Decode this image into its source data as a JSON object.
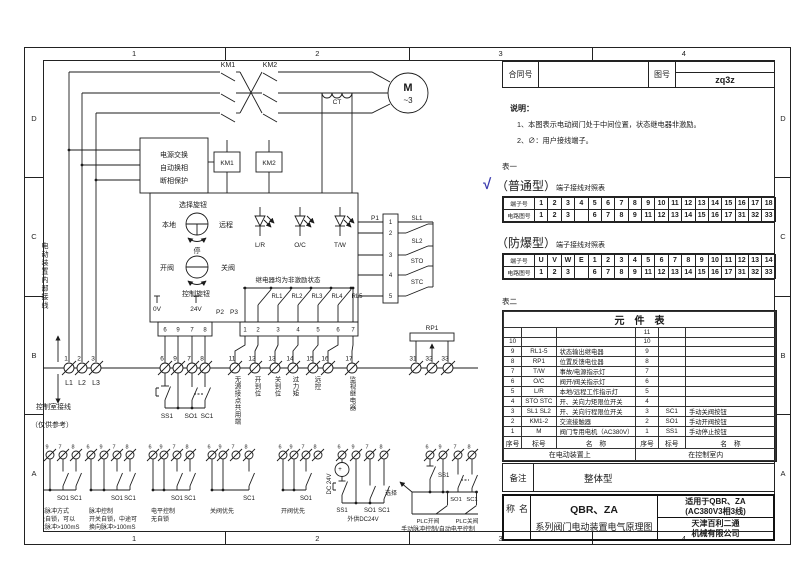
{
  "frame": {
    "top_zones": [
      "1",
      "2",
      "3",
      "4"
    ],
    "bottom_zones": [
      "1",
      "2",
      "3",
      "4"
    ],
    "left_zones": [
      "D",
      "C",
      "B",
      "A"
    ],
    "right_zones": [
      "D",
      "C",
      "B",
      "A"
    ]
  },
  "header": {
    "contract_label": "合同号",
    "drawing_label": "图号",
    "drawing_no": "zq3z"
  },
  "notes": {
    "title": "说明：",
    "items": [
      "1、本图表示电动阀门处于中间位置，状态继电器非激励。",
      "2、∅：用户接线端子。"
    ]
  },
  "table1": {
    "label": "表一",
    "check": "√",
    "normal": {
      "title": "（普通型）",
      "subtitle": "端子接线对照表",
      "row1_label": "端子号",
      "row2_label": "电路图号",
      "terminals": [
        "1",
        "2",
        "3",
        "4",
        "5",
        "6",
        "7",
        "8",
        "9",
        "10",
        "11",
        "12",
        "13",
        "14",
        "15",
        "16",
        "17",
        "18"
      ],
      "circuits": [
        "1",
        "2",
        "3",
        "",
        "6",
        "7",
        "8",
        "9",
        "11",
        "12",
        "13",
        "14",
        "15",
        "16",
        "17",
        "31",
        "32",
        "33"
      ]
    },
    "explosion": {
      "title": "（防爆型）",
      "subtitle": "端子接线对照表",
      "row1_label": "端子号",
      "row2_label": "电路图号",
      "terminals": [
        "U",
        "V",
        "W",
        "E",
        "1",
        "2",
        "3",
        "4",
        "5",
        "6",
        "7",
        "8",
        "9",
        "10",
        "11",
        "12",
        "13",
        "14"
      ],
      "circuits": [
        "1",
        "2",
        "3",
        "",
        "6",
        "7",
        "8",
        "9",
        "11",
        "12",
        "13",
        "14",
        "15",
        "16",
        "17",
        "31",
        "32",
        "33"
      ]
    }
  },
  "table2": {
    "label": "表二",
    "title": "元　件　表",
    "header": [
      "序号",
      "标号",
      "名　称",
      "序号",
      "标号",
      "名　称"
    ],
    "rows": [
      [
        "",
        "",
        "",
        "11",
        "",
        ""
      ],
      [
        "10",
        "",
        "",
        "10",
        "",
        ""
      ],
      [
        "9",
        "RL1-5",
        "状态输出继电器",
        "9",
        "",
        ""
      ],
      [
        "8",
        "RP1",
        "位置反馈电位器",
        "8",
        "",
        ""
      ],
      [
        "7",
        "T/W",
        "事故/电源指示灯",
        "7",
        "",
        ""
      ],
      [
        "6",
        "O/C",
        "阀开/阀关指示灯",
        "6",
        "",
        ""
      ],
      [
        "5",
        "L/R",
        "本地/远程工作指示灯",
        "5",
        "",
        ""
      ],
      [
        "4",
        "STO STC",
        "开、关向力矩限位开关",
        "4",
        "",
        ""
      ],
      [
        "3",
        "SL1 SL2",
        "开、关向行程限位开关",
        "3",
        "SC1",
        "手动关阀按钮"
      ],
      [
        "2",
        "KM1-2",
        "交流接触器",
        "2",
        "SO1",
        "手动开阀按钮"
      ],
      [
        "1",
        "M",
        "阀门专用电机（AC380V）",
        "1",
        "SS1",
        "手动停止按钮"
      ]
    ],
    "footer_left": "在电动装置上",
    "footer_right": "在控制室内"
  },
  "remark": {
    "label": "备注",
    "value": "整体型"
  },
  "titleblock": {
    "name_label": "名称",
    "product": "QBR、ZA",
    "series": "系列阀门电动装置电气原理图",
    "apply_line1": "适用于QBR、ZA",
    "apply_line2": "(AC380V3相3线)",
    "company_line1": "天津百利二通",
    "company_line2": "机械有限公司"
  },
  "schematic": {
    "km1": "KM1",
    "km2": "KM2",
    "motor": "M",
    "motor_phase": "~3",
    "ct": "CT",
    "power_box_lines": [
      "电源交换",
      "自动换相",
      "断相保护"
    ],
    "km1_coil": "KM1",
    "km2_coil": "KM2",
    "selector_title": "选择旋钮",
    "local": "本地",
    "remote": "远程",
    "stop": "停",
    "open_valve": "开阀",
    "close_valve": "关阀",
    "control_knob": "控制旋钮",
    "leds": [
      "L/R",
      "O/C",
      "T/W"
    ],
    "relay_note": "继电器均为非激励状态",
    "relays": [
      "RL1",
      "RL2",
      "RL3",
      "RL4",
      "RL5"
    ],
    "p1": "P1",
    "p1_pins": [
      "1",
      "2",
      "3",
      "4",
      "5"
    ],
    "limit_switches": [
      "SL1",
      "SL2",
      "STO",
      "STC"
    ],
    "v0": "0V",
    "v24": "24V",
    "p2": "P2",
    "p3": "P3",
    "p2_pins": [
      "6",
      "9",
      "7",
      "8"
    ],
    "p3_pins": [
      "1",
      "2",
      "3",
      "4",
      "5",
      "6",
      "7"
    ],
    "rp1": "RP1",
    "phase_terminals": [
      "1",
      "2",
      "3"
    ],
    "phase_labels": [
      "L1",
      "L2",
      "L3"
    ],
    "ctrl_terminals": [
      "6",
      "9",
      "7",
      "8"
    ],
    "signal_terminals": [
      "11",
      "12",
      "13",
      "14",
      "15",
      "16",
      "17"
    ],
    "pot_terminals": [
      "31",
      "32",
      "33"
    ],
    "buttons": [
      "SS1",
      "SO1",
      "SC1"
    ],
    "signal_labels": [
      "无源接点共用端",
      "开到位",
      "关到位",
      "过力矩",
      "远控",
      "监视继电器"
    ],
    "internal_wiring": "电动装置内部接线",
    "room_wiring": "控制室接线",
    "reference_only": "（仅供参考）",
    "groups": [
      {
        "terminals": [
          "6",
          "9",
          "7",
          "8"
        ],
        "buttons": [
          "SS1",
          "SO1",
          "SC1"
        ],
        "caption": [
          "标准脉冲方式",
          "开关自锁，可以",
          "停止脉冲>100mS"
        ]
      },
      {
        "terminals": [
          "6",
          "9",
          "7",
          "8"
        ],
        "buttons": [
          "SO1",
          "SC1"
        ],
        "caption": [
          "脉冲控制",
          "开关自锁，中途可",
          "换向脉冲>100mS"
        ]
      },
      {
        "terminals": [
          "6",
          "9",
          "7",
          "8"
        ],
        "buttons": [
          "SO1",
          "SC1"
        ],
        "caption": [
          "电平控制",
          "无自锁"
        ]
      },
      {
        "terminals": [
          "6",
          "9",
          "7",
          "8"
        ],
        "buttons": [
          "SC1"
        ],
        "caption": [
          "关阀优先"
        ]
      },
      {
        "terminals": [
          "6",
          "9",
          "7",
          "8"
        ],
        "buttons": [
          "SO1"
        ],
        "caption": [
          "开阀优先"
        ]
      },
      {
        "terminals": [
          "6",
          "9",
          "7",
          "8"
        ],
        "buttons": [
          "SS1",
          "SO1",
          "SC1"
        ],
        "source": "DC 24V",
        "polarity": "+",
        "caption": [
          "外供DC24V"
        ]
      },
      {
        "terminals": [
          "6",
          "9",
          "7",
          "8"
        ],
        "buttons": [
          "SS1",
          "选择",
          "SO1",
          "SC1",
          "PLC开阀",
          "PLC关阀"
        ],
        "caption": [
          "手动脉冲控制/自动电平控制"
        ]
      }
    ]
  }
}
